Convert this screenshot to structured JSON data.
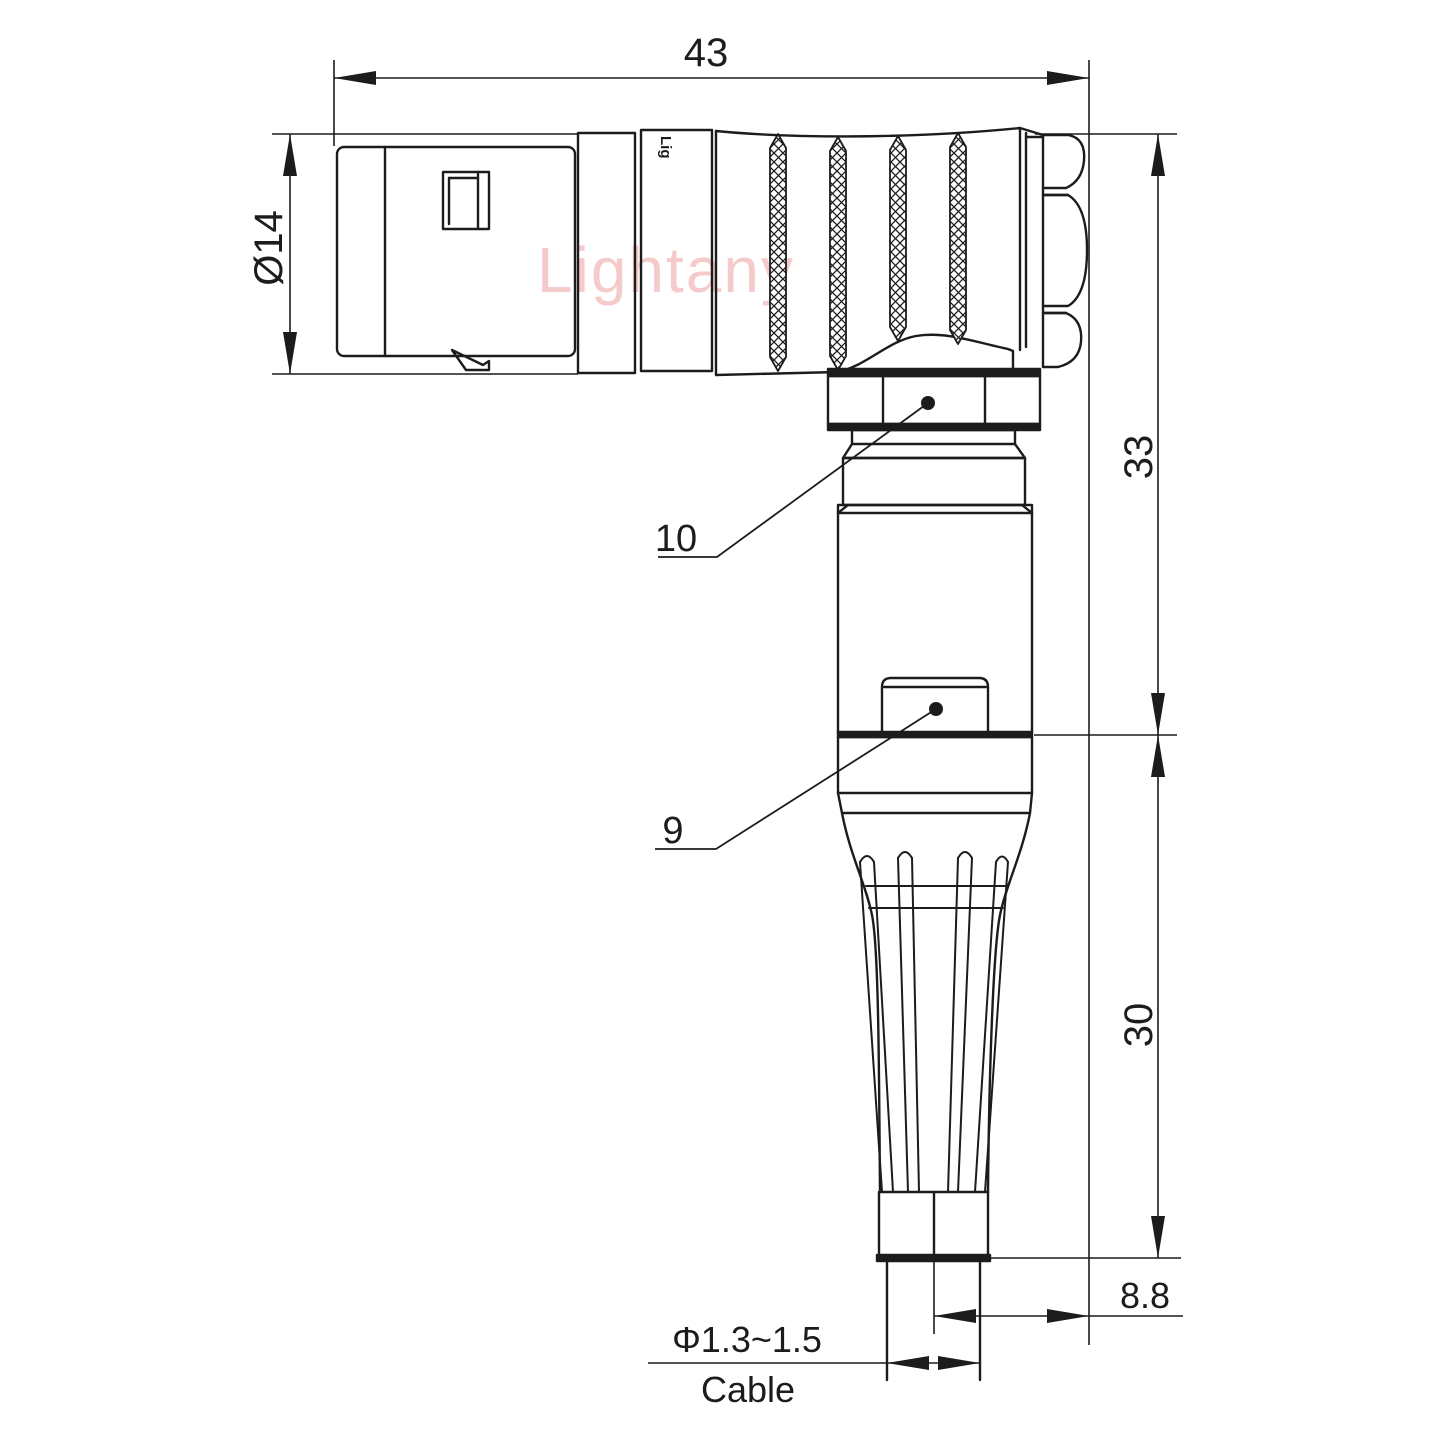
{
  "drawing": {
    "watermark": "Lightany",
    "engraving": "Lig",
    "dimensions": {
      "overall_length": "43",
      "front_diameter": "Ø14",
      "upper_height": "33",
      "lower_height": "30",
      "axis_to_back": "8.8",
      "cable_range": "Φ1.3~1.5",
      "cable_word": "Cable"
    },
    "part_labels": {
      "coupling_nut": "10",
      "boot_nut": "9"
    }
  },
  "colors": {
    "line": "#1c1c1c",
    "watermark": "#f5caca",
    "background": "#ffffff"
  }
}
